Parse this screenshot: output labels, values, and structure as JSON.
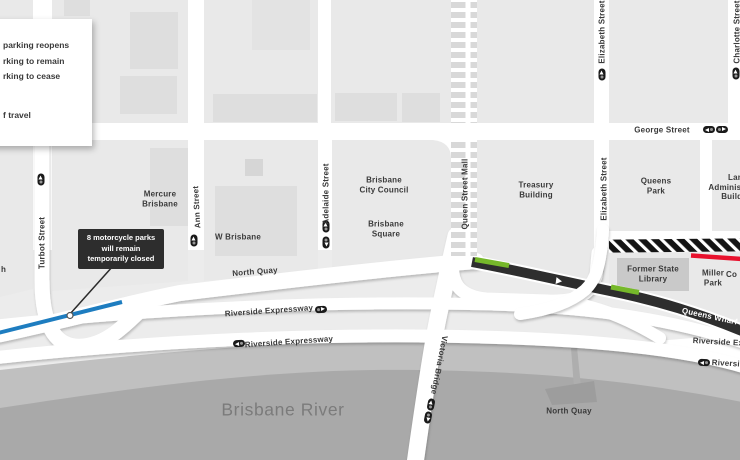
{
  "legend": {
    "line1": "parking reopens",
    "line2": "rking to remain",
    "line3": "rking to cease",
    "line4": "f travel"
  },
  "callout": {
    "text": "8 motorcycle parks\nwill remain\ntemporarily closed"
  },
  "fragments": {
    "left_edge": "h",
    "right_edge_place": "Co"
  },
  "streets": {
    "turbot": "Turbot Street",
    "ann": "Ann Street",
    "adelaide": "Adelaide Street",
    "queen_street_mall": "Queen Street Mall",
    "elizabeth_top": "Elizabeth Street",
    "elizabeth_mid": "Elizabeth Street",
    "charlotte": "Charlotte Street",
    "george": "George Street",
    "north_quay": "North Quay",
    "riverside_upper": "Riverside Expressway",
    "riverside_lower": "Riverside Expressway",
    "riverside_right_upper": "Riverside Expressway",
    "riverside_right_lower": "Riverside Expressway",
    "queens_wharf_road": "Queens Wharf Rd",
    "victoria_bridge": "Victoria Bridge"
  },
  "places": {
    "mercure": "Mercure\nBrisbane",
    "w_brisbane": "W Brisbane",
    "city_council": "Brisbane\nCity Council",
    "brisbane_square": "Brisbane\nSquare",
    "treasury": "Treasury\nBuilding",
    "queens_park": "Queens\nPark",
    "land_admin": "Land\nAdministration\nBuilding",
    "former_state_library": "Former State\nLibrary",
    "miller_park": "Miller\nPark",
    "north_quay_terminal": "North Quay",
    "brisbane_river": "Brisbane River"
  },
  "colors": {
    "open_parking_green": "#76b82a",
    "travel_direction_blue": "#1e7dc0",
    "closed_red": "#e8112d",
    "closed_road_dark": "#2e2e2e",
    "callout_bg": "#2d2d2d"
  }
}
